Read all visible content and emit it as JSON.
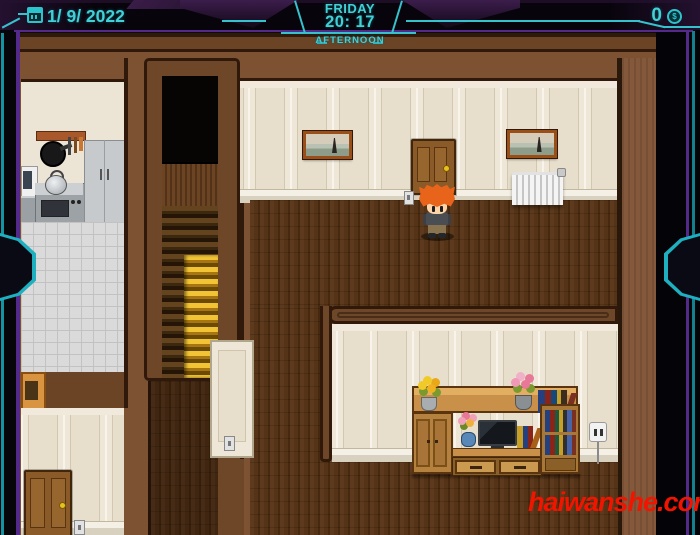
{
  "hud": {
    "date": "1/ 9/ 2022",
    "weekday": "FRIDAY",
    "time": "20: 17",
    "daypart": "AFTERNOON",
    "gold_amount": "0",
    "coin_symbol": "$",
    "accent_color": "#41d0d6",
    "frame_purple": "#53298a",
    "icons": {
      "calendar": "calendar-icon",
      "coin": "coin-icon"
    }
  },
  "scene": {
    "description": "RPG-style house interior cross-section with kitchen, staircase, upper hallway and living room",
    "rooms": [
      "kitchen",
      "staircase",
      "upper-hallway",
      "lower-left-room",
      "living-room"
    ],
    "objects": [
      {
        "name": "player-character",
        "detail": "boy with spiky orange hair, grey shirt, khaki pants"
      },
      {
        "name": "hall-door",
        "detail": "wooden panel door with gold knob"
      },
      {
        "name": "left-room-door",
        "detail": "wooden panel door with gold knob"
      },
      {
        "name": "landscape-painting-left"
      },
      {
        "name": "landscape-painting-right"
      },
      {
        "name": "radiator"
      },
      {
        "name": "pot-rack"
      },
      {
        "name": "microwave"
      },
      {
        "name": "stove-with-kettle"
      },
      {
        "name": "refrigerator"
      },
      {
        "name": "entertainment-center",
        "detail": "wooden shelving with TV, books, flower pots, drawers"
      },
      {
        "name": "television"
      },
      {
        "name": "bookshelf"
      },
      {
        "name": "wall-outlet"
      },
      {
        "name": "light-switches"
      },
      {
        "name": "golden-staircase"
      }
    ],
    "colors": {
      "wall_brown": "#7d5233",
      "trim_dark": "#30190a",
      "wall_cream": "#ece5d6",
      "floor_plank": "#573418",
      "stair_gold": "#e3a81e",
      "kitchen_tile": "#dadada"
    }
  },
  "watermark": {
    "text": "haiwanshe.com",
    "color": "#f31400"
  }
}
